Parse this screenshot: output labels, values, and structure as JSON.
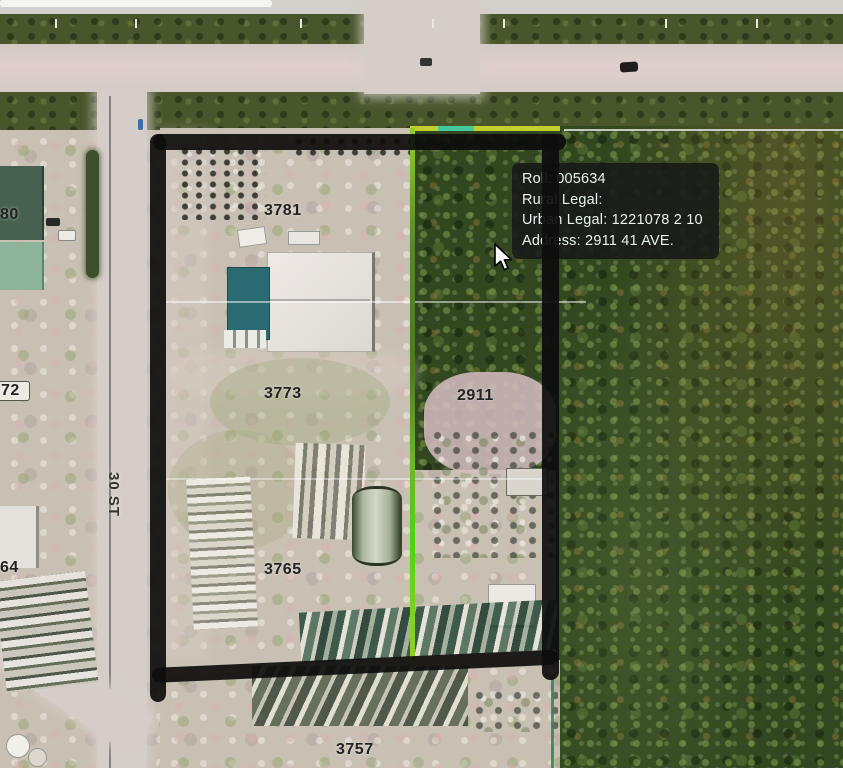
{
  "tooltip": {
    "lines": [
      "Roll: 005634",
      "Rural Legal:",
      "Urban Legal: 1221078 2 10",
      "Address: 2911 41 AVE."
    ]
  },
  "labels": {
    "parcels": [
      {
        "text": "3781"
      },
      {
        "text": "3773"
      },
      {
        "text": "3765"
      },
      {
        "text": "3757"
      },
      {
        "text": "2911"
      }
    ],
    "west_partial": [
      {
        "text": "80"
      },
      {
        "text": "72"
      },
      {
        "text": "64"
      }
    ],
    "street": "30 ST"
  },
  "colors": {
    "parcel_outline": "#0d0d0d",
    "highlight_line_green": "#76c420",
    "highlight_line_yellow": "#c3cf2c",
    "highlight_line_cyan": "#35c9a8",
    "tooltip_background": "rgba(24,26,24,0.9)",
    "tooltip_text": "#e9f3ed"
  }
}
